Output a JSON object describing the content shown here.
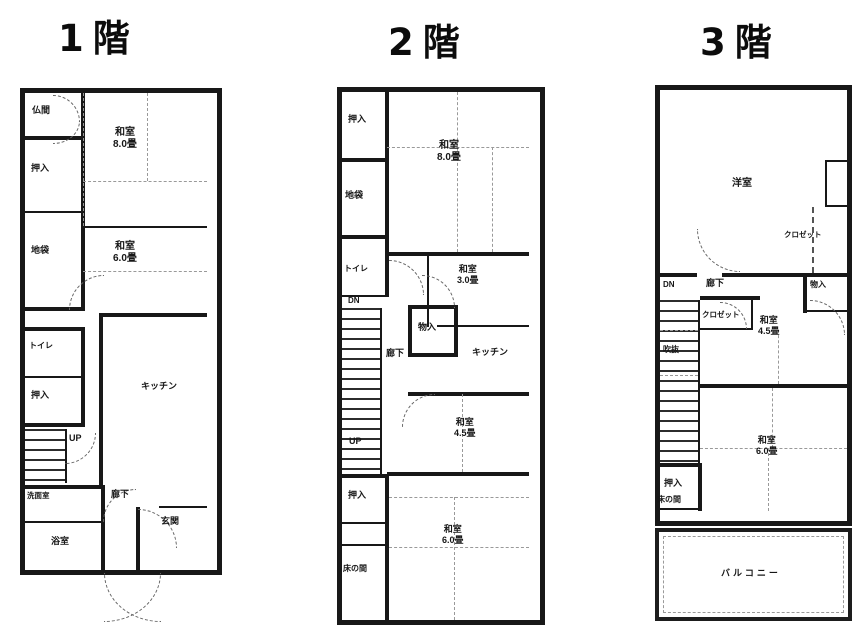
{
  "floors": [
    {
      "title": "1階",
      "labels": {
        "butsuma": "仏間",
        "oshiire_a": "押入",
        "jibukuro": "地袋",
        "washitsu_a": "和室",
        "washitsu_a_size": "8.0畳",
        "washitsu_b": "和室",
        "washitsu_b_size": "6.0畳",
        "toilet": "トイレ",
        "oshiire_b": "押入",
        "up": "UP",
        "kitchen": "キッチン",
        "hallway": "廊下",
        "washroom": "洗面室",
        "bath": "浴室",
        "entrance": "玄関"
      }
    },
    {
      "title": "2階",
      "labels": {
        "oshiire_a": "押入",
        "washitsu_a": "和室",
        "washitsu_a_size": "8.0畳",
        "jibukuro": "地袋",
        "toilet": "トイレ",
        "dn": "DN",
        "hallway": "廊下",
        "monoire": "物入",
        "washitsu_b": "和室",
        "washitsu_b_size": "3.0畳",
        "kitchen": "キッチン",
        "washitsu_c": "和室",
        "washitsu_c_size": "4.5畳",
        "up": "UP",
        "oshiire_b": "押入",
        "tokonoma": "床の間",
        "washitsu_d": "和室",
        "washitsu_d_size": "6.0畳"
      }
    },
    {
      "title": "3階",
      "labels": {
        "youshitsu": "洋室",
        "closet_a": "クロゼット",
        "dn": "DN",
        "hallway": "廊下",
        "monoire": "物入",
        "closet_b": "クロゼット",
        "washitsu_a": "和室",
        "washitsu_a_size": "4.5畳",
        "fukinuke": "吹抜",
        "oshiire": "押入",
        "washitsu_b": "和室",
        "washitsu_b_size": "6.0畳",
        "tokonoma": "床の間",
        "balcony": "バルコニー"
      }
    }
  ]
}
